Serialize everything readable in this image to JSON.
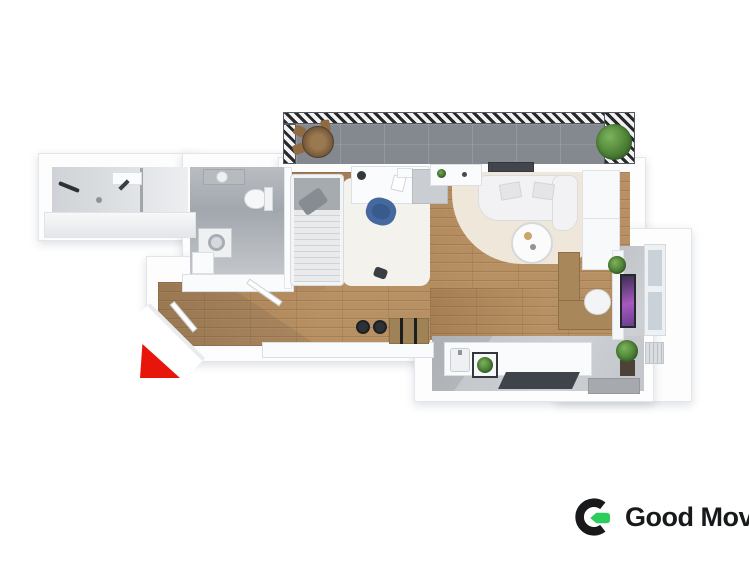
{
  "branding": {
    "logo_text": "Good Move"
  },
  "colors": {
    "wood": "#b3895a",
    "balcony": "#84888f",
    "tile": "#a8adb4",
    "wall": "#fdfdfd",
    "red": "#e8150b",
    "green": "#2ecc5e",
    "black": "#17191b"
  },
  "floorplan": {
    "areas": [
      "balcony",
      "bathroom",
      "toilet-laundry",
      "bedroom",
      "living-room",
      "entrance-hall",
      "kitchen",
      "home-office"
    ],
    "furniture": [
      "balcony-table",
      "balcony-chairs",
      "potted-plant",
      "shower",
      "washbasin",
      "toilet",
      "washing-machine",
      "single-bed",
      "desk",
      "desk-chair",
      "dresser",
      "sofa",
      "coffee-table",
      "area-rug",
      "wardrobe",
      "tv",
      "office-desk",
      "office-chair",
      "window",
      "radiator",
      "kitchen-counter",
      "kitchen-sink",
      "bar-stools",
      "entrance-arrow"
    ]
  }
}
